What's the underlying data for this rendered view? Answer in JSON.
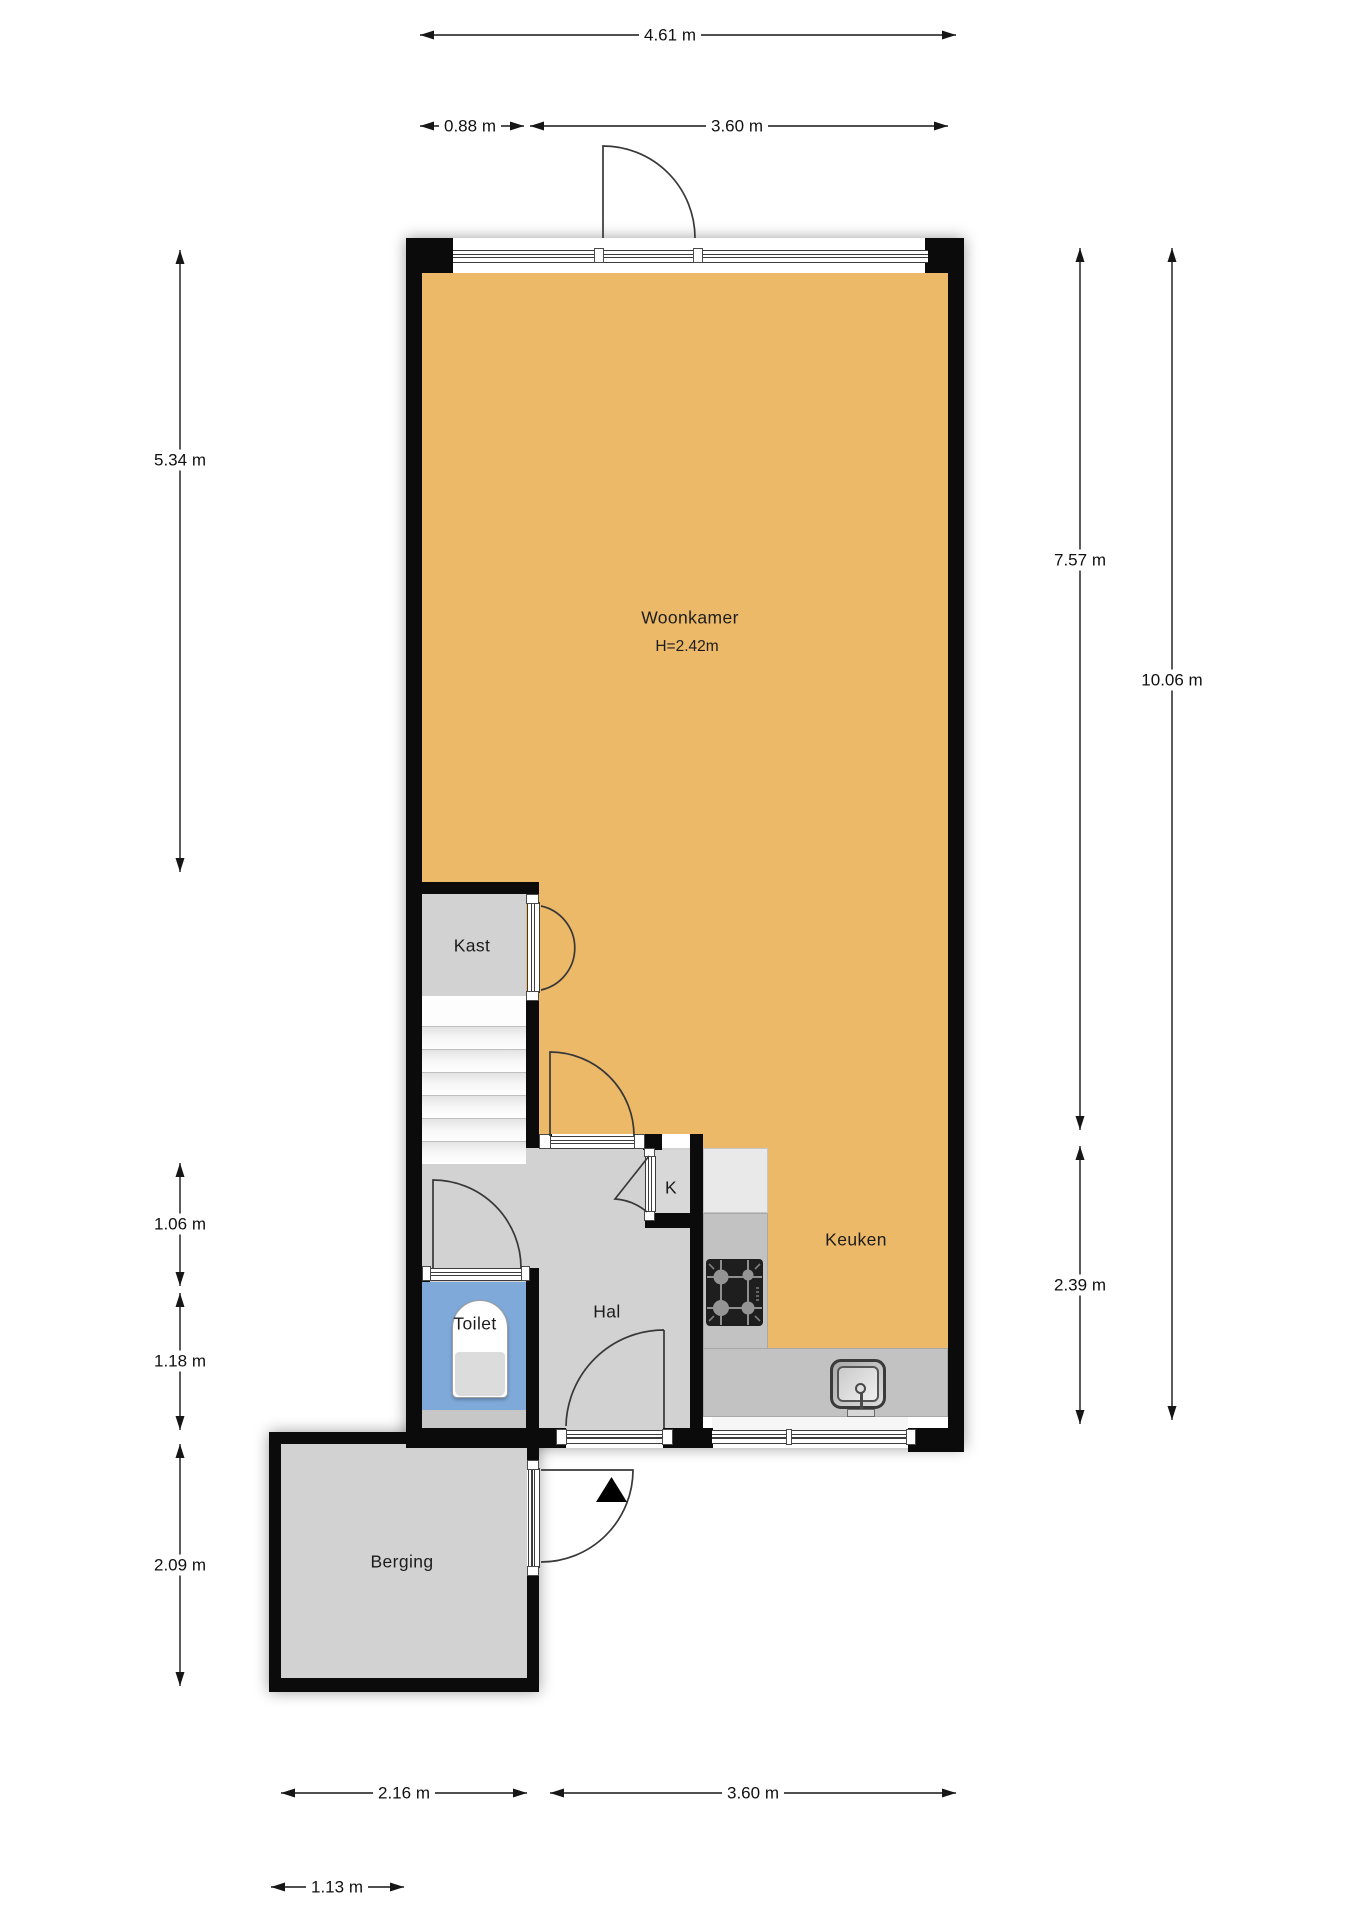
{
  "plan_title": "floor-plan",
  "colors": {
    "wall": "#0b0b0b",
    "living_floor": "#ECB968",
    "hall_floor": "#D2D2D2",
    "closet_floor": "#D8D8D8",
    "toilet_floor": "#7FA9D9",
    "storage_floor": "#D2D2D2",
    "counter": "#C2C2C2",
    "cabinet": "#E9E9E9"
  },
  "rooms": {
    "woonkamer": {
      "label": "Woonkamer",
      "ceiling_height": "H=2.42m"
    },
    "kast": {
      "label": "Kast"
    },
    "hal": {
      "label": "Hal"
    },
    "toilet": {
      "label": "Toilet"
    },
    "kitchen_closet": {
      "label": "K"
    },
    "keuken": {
      "label": "Keuken"
    },
    "berging": {
      "label": "Berging"
    }
  },
  "dimensions": {
    "top_total": "4.61 m",
    "top_left_segment": "0.88 m",
    "top_right_segment": "3.60 m",
    "left_upper": "5.34 m",
    "left_middle_1": "1.06 m",
    "left_middle_2": "1.18 m",
    "left_lower": "2.09 m",
    "right_living": "7.57 m",
    "right_total": "10.06 m",
    "right_kitchen": "2.39 m",
    "bottom_berging": "2.16 m",
    "bottom_kitchen": "3.60 m",
    "bottom_offset": "1.13 m"
  }
}
